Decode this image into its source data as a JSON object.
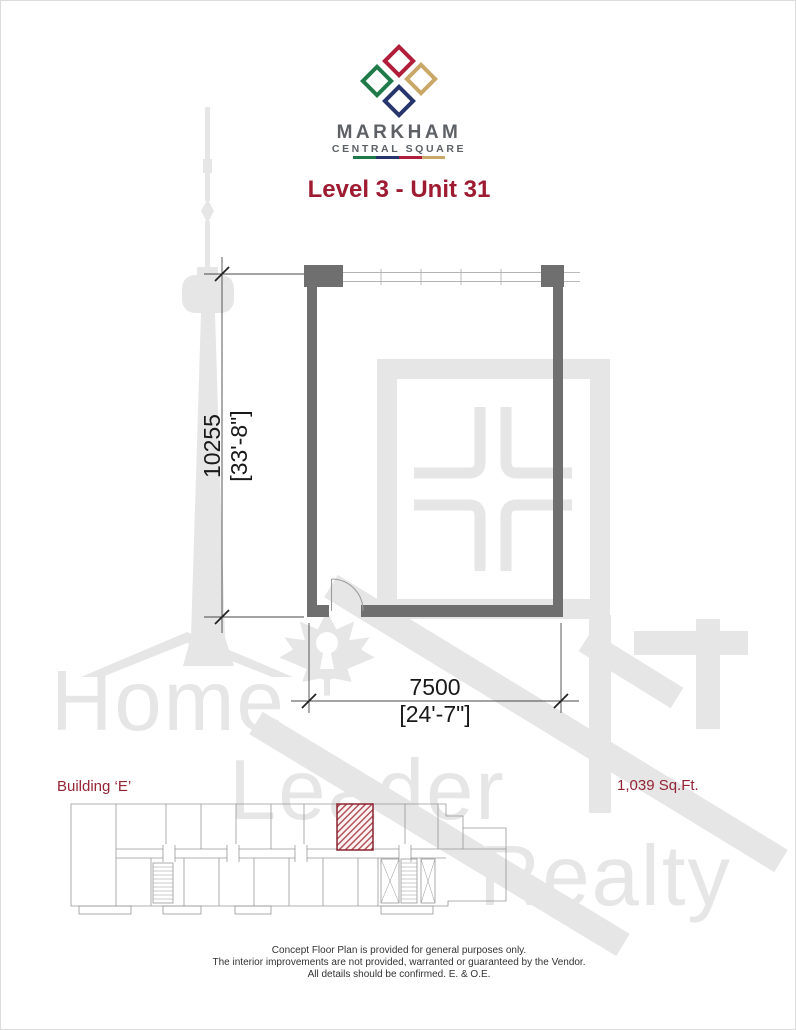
{
  "logo": {
    "brand": "MARKHAM",
    "sub_brand": "CENTRAL SQUARE",
    "diamond_colors": {
      "left": "#1e7a49",
      "top": "#b01e3c",
      "right": "#c9a767",
      "bottom": "#27356d"
    },
    "underline_colors": [
      "#1e7a49",
      "#27356d",
      "#b01e3c",
      "#c9a767"
    ]
  },
  "title": {
    "label": "Level 3 - Unit 31"
  },
  "unit_plan": {
    "vertical_dim_metric": "10255",
    "vertical_dim_imperial": "[33'-8\"]",
    "horizontal_dim_metric": "7500",
    "horizontal_dim_imperial": "[24'-7\"]"
  },
  "key_plan": {
    "building_label": "Building ‘E’",
    "area": "1,039 Sq.Ft."
  },
  "watermark": {
    "word1": "Home",
    "word2": "Leader",
    "word3": "Realty"
  },
  "disclaimer": {
    "line1": "Concept Floor Plan is provided for general purposes only.",
    "line2": "The interior improvements are not provided, warranted or guaranteed by the Vendor.",
    "line3": "All details should be confirmed.  E. & O.E."
  },
  "colors": {
    "accent_red": "#9e1b32",
    "label_red": "#942435",
    "wall_gray": "#6f6f6f",
    "hatch_red": "#b04a52",
    "hatch_border_red": "#8b2332",
    "watermark_gray": "#e6e6e6"
  }
}
